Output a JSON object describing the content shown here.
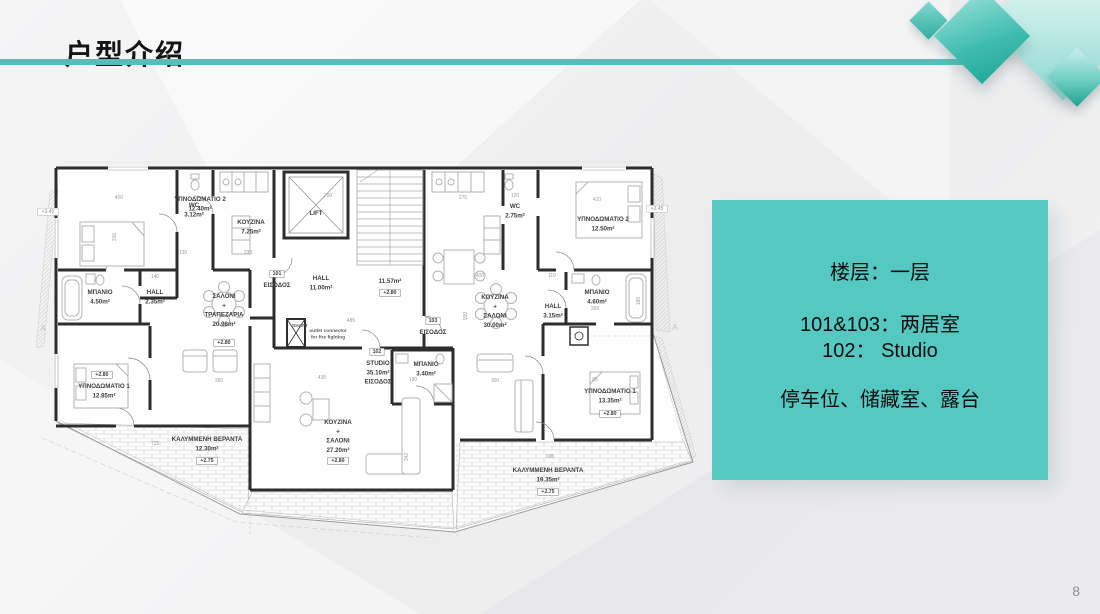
{
  "slide": {
    "title": "户型介绍",
    "page_number": "8",
    "accent_color": "#4cc3ba",
    "info_box": {
      "bg_color": "#55c8c1",
      "line1": "楼层：一层",
      "line2": "101&103：两居室",
      "line3": "102：  Studio",
      "line4": "停车位、储藏室、露台"
    }
  },
  "floorplan": {
    "labels": [
      {
        "x": 164,
        "y": 43,
        "cls": "room",
        "lines": [
          "ΥΠΝΟΔΩΜΑΤΙΟ 2",
          "12.40m²"
        ]
      },
      {
        "x": 158,
        "y": 49,
        "cls": "room",
        "lines": [
          "WC",
          "3.12m²"
        ]
      },
      {
        "x": 215,
        "y": 66,
        "cls": "room",
        "lines": [
          "ΚΟΥΖΙΝΑ",
          "7.25m²"
        ]
      },
      {
        "x": 280,
        "y": 57,
        "cls": "room",
        "lines": [
          "LIFT"
        ]
      },
      {
        "x": 64,
        "y": 136,
        "cls": "room",
        "lines": [
          "ΜΠΑΝΙΟ",
          "4.50m²"
        ]
      },
      {
        "x": 119,
        "y": 136,
        "cls": "room",
        "lines": [
          "HALL",
          "2.35m²"
        ]
      },
      {
        "x": 188,
        "y": 140,
        "cls": "room",
        "lines": [
          "ΣΑΛΟΝΙ",
          "+",
          "ΤΡΑΠΕΖΑΡΙΑ",
          "20.98m²"
        ]
      },
      {
        "x": 188,
        "y": 186,
        "cls": "tag",
        "lines": [
          "+2.80"
        ]
      },
      {
        "x": 241,
        "y": 117,
        "cls": "tag",
        "lines": [
          "101"
        ]
      },
      {
        "x": 241,
        "y": 129,
        "cls": "room",
        "lines": [
          "ΕΙΣΟΔΟΣ"
        ]
      },
      {
        "x": 285,
        "y": 122,
        "cls": "room",
        "lines": [
          "HALL",
          "11.00m²"
        ]
      },
      {
        "x": 354,
        "y": 125,
        "cls": "room",
        "lines": [
          "11.57m²"
        ]
      },
      {
        "x": 354,
        "y": 136,
        "cls": "tag",
        "lines": [
          "+2.80"
        ]
      },
      {
        "x": 264,
        "y": 169,
        "cls": "tiny",
        "lines": [
          "SHAFT"
        ]
      },
      {
        "x": 292,
        "y": 174,
        "cls": "tiny",
        "lines": [
          "outlet connector",
          "for fire fighting"
        ]
      },
      {
        "x": 66,
        "y": 218,
        "cls": "tag",
        "lines": [
          "+2.80"
        ]
      },
      {
        "x": 68,
        "y": 230,
        "cls": "room",
        "lines": [
          "ΥΠΝΟΔΩΜΑΤΙΟ 1",
          "12.85m²"
        ]
      },
      {
        "x": 171,
        "y": 283,
        "cls": "room",
        "lines": [
          "ΚΑΛΥΜΜΕΝΗ ΒΕΡΑΝΤΑ",
          "12.30m²"
        ]
      },
      {
        "x": 171,
        "y": 304,
        "cls": "tag",
        "lines": [
          "+2.75"
        ]
      },
      {
        "x": 341,
        "y": 195,
        "cls": "tag",
        "lines": [
          "102"
        ]
      },
      {
        "x": 342,
        "y": 207,
        "cls": "room",
        "lines": [
          "STUDIO",
          "35.10m²",
          "ΕΙΣΟΔΟΣ"
        ]
      },
      {
        "x": 390,
        "y": 208,
        "cls": "room",
        "lines": [
          "ΜΠΑΝΙΟ",
          "3.40m²"
        ]
      },
      {
        "x": 302,
        "y": 266,
        "cls": "room",
        "lines": [
          "ΚΟΥΖΙΝΑ",
          "+",
          "ΣΑΛΟΝΙ",
          "27.20m²"
        ]
      },
      {
        "x": 302,
        "y": 304,
        "cls": "tag",
        "lines": [
          "+2.80"
        ]
      },
      {
        "x": 479,
        "y": 50,
        "cls": "room",
        "lines": [
          "WC",
          "2.75m²"
        ]
      },
      {
        "x": 567,
        "y": 63,
        "cls": "room",
        "lines": [
          "ΥΠΝΟΔΩΜΑΤΙΟ 2",
          "12.50m²"
        ]
      },
      {
        "x": 459,
        "y": 141,
        "cls": "room",
        "lines": [
          "ΚΟΥΖΙΝΑ",
          "+",
          "ΣΑΛΟΝΙ",
          "30.00m²"
        ]
      },
      {
        "x": 517,
        "y": 150,
        "cls": "room",
        "lines": [
          "HALL",
          "3.15m²"
        ]
      },
      {
        "x": 561,
        "y": 136,
        "cls": "room",
        "lines": [
          "ΜΠΑΝΙΟ",
          "4.60m²"
        ]
      },
      {
        "x": 397,
        "y": 164,
        "cls": "tag",
        "lines": [
          "103"
        ]
      },
      {
        "x": 397,
        "y": 176,
        "cls": "room",
        "lines": [
          "ΕΙΣΟΔΟΣ"
        ]
      },
      {
        "x": 574,
        "y": 235,
        "cls": "room",
        "lines": [
          "ΥΠΝΟΔΩΜΑΤΙΟ 1",
          "13.35m²"
        ]
      },
      {
        "x": 574,
        "y": 257,
        "cls": "tag",
        "lines": [
          "+2.80"
        ]
      },
      {
        "x": 512,
        "y": 314,
        "cls": "room",
        "lines": [
          "ΚΑΛΥΜΜΕΝΗ ΒΕΡΑΝΤΑ",
          "19.35m²"
        ]
      },
      {
        "x": 512,
        "y": 335,
        "cls": "tag",
        "lines": [
          "+2.75"
        ]
      },
      {
        "x": 12,
        "y": 55,
        "cls": "marker",
        "lines": [
          "+3.45"
        ]
      },
      {
        "x": 621,
        "y": 52,
        "cls": "marker",
        "lines": [
          "+3.45"
        ]
      },
      {
        "x": 7,
        "y": 173,
        "cls": "axis",
        "lines": [
          "A"
        ]
      },
      {
        "x": 639,
        "y": 172,
        "cls": "axis",
        "lines": [
          "A"
        ]
      },
      {
        "x": 83,
        "y": 41,
        "cls": "dim",
        "lines": [
          "400"
        ]
      },
      {
        "x": 292,
        "y": 39,
        "cls": "dim",
        "lines": [
          "200"
        ]
      },
      {
        "x": 427,
        "y": 41,
        "cls": "dim",
        "lines": [
          "270"
        ]
      },
      {
        "x": 479,
        "y": 39,
        "cls": "dim",
        "lines": [
          "120"
        ]
      },
      {
        "x": 561,
        "y": 43,
        "cls": "dim",
        "lines": [
          "410"
        ]
      },
      {
        "x": 147,
        "y": 96,
        "cls": "dim",
        "lines": [
          "130"
        ]
      },
      {
        "x": 212,
        "y": 96,
        "cls": "dim",
        "lines": [
          "230"
        ]
      },
      {
        "x": 119,
        "y": 120,
        "cls": "dim",
        "lines": [
          "140"
        ]
      },
      {
        "x": 444,
        "y": 119,
        "cls": "dim",
        "lines": [
          "400"
        ]
      },
      {
        "x": 516,
        "y": 119,
        "cls": "dim",
        "lines": [
          "110"
        ]
      },
      {
        "x": 315,
        "y": 164,
        "cls": "dim",
        "lines": [
          "485"
        ]
      },
      {
        "x": 559,
        "y": 152,
        "cls": "dim",
        "lines": [
          "265"
        ]
      },
      {
        "x": 183,
        "y": 224,
        "cls": "dim",
        "lines": [
          "350"
        ]
      },
      {
        "x": 286,
        "y": 221,
        "cls": "dim",
        "lines": [
          "435"
        ]
      },
      {
        "x": 377,
        "y": 223,
        "cls": "dim",
        "lines": [
          "190"
        ]
      },
      {
        "x": 459,
        "y": 224,
        "cls": "dim",
        "lines": [
          "300"
        ]
      },
      {
        "x": 559,
        "y": 223,
        "cls": "dim",
        "lines": [
          "85"
        ]
      },
      {
        "x": 119,
        "y": 287,
        "cls": "dim",
        "lines": [
          "725"
        ]
      },
      {
        "x": 514,
        "y": 300,
        "cls": "dim",
        "lines": [
          "695"
        ]
      },
      {
        "x": 80,
        "y": 79,
        "cls": "dim",
        "rot": -90,
        "lines": [
          "310"
        ]
      },
      {
        "x": 604,
        "y": 143,
        "cls": "dim",
        "rot": -90,
        "lines": [
          "180"
        ]
      },
      {
        "x": 431,
        "y": 158,
        "cls": "dim",
        "rot": -90,
        "lines": [
          "900"
        ]
      },
      {
        "x": 372,
        "y": 299,
        "cls": "dim",
        "rot": -90,
        "lines": [
          "342"
        ]
      }
    ]
  }
}
